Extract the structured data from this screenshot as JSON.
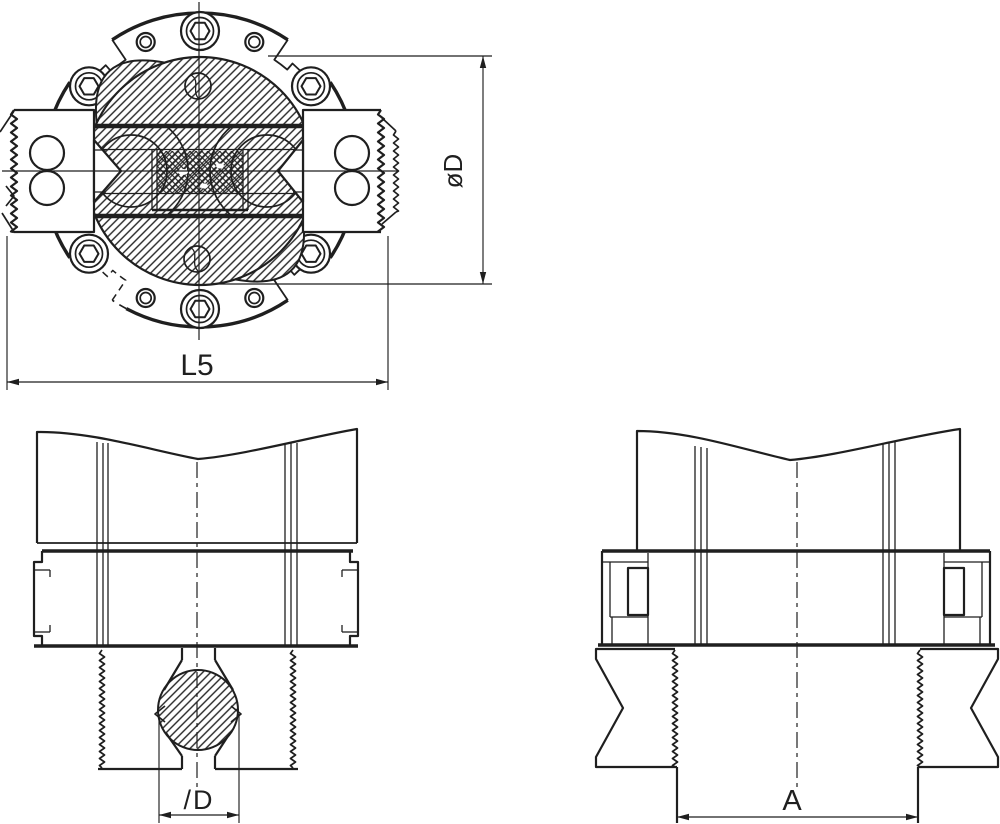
{
  "colors": {
    "ink": "#1f1f1f",
    "background": "#ffffff"
  },
  "labels": {
    "front_diameter": "øD",
    "front_width": "L5",
    "section_bar_diameter": "/D",
    "section_spindle_width": "A"
  }
}
